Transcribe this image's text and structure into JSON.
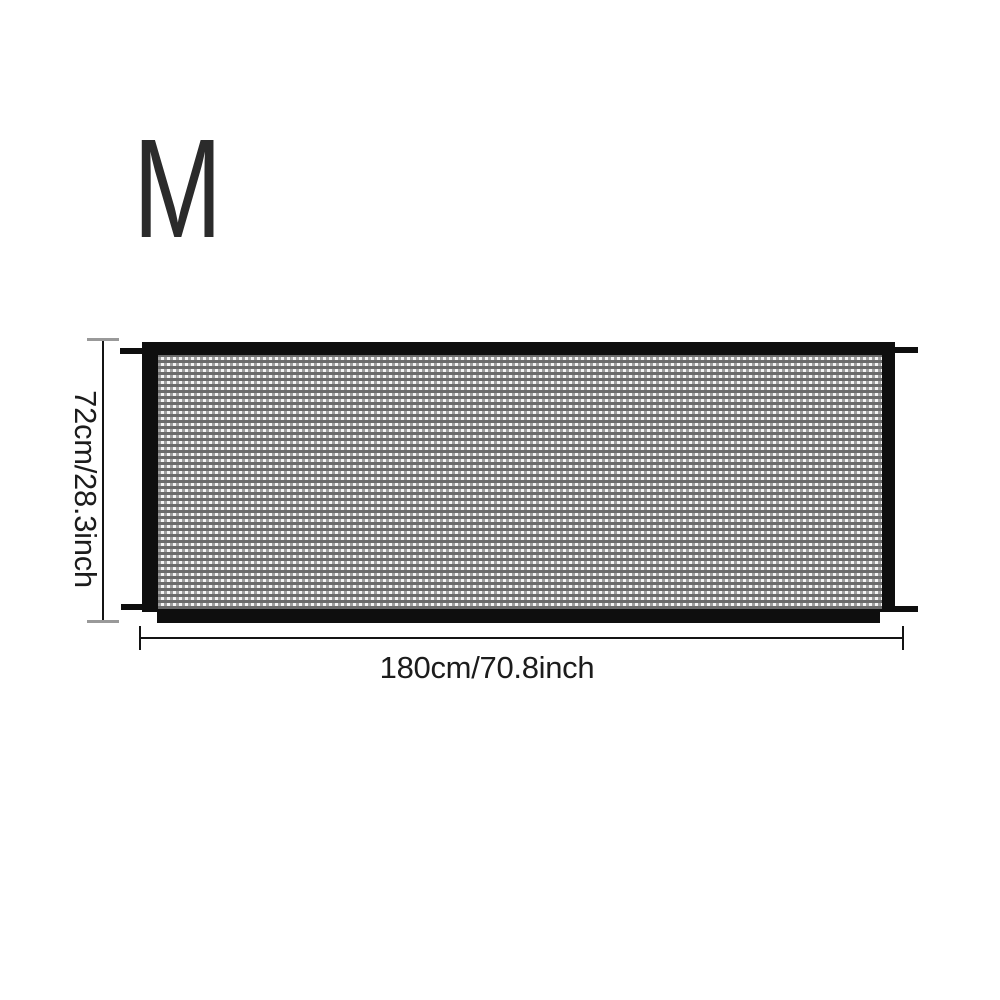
{
  "product_diagram": {
    "size_label": "M",
    "height_label": "72cm/28.3inch",
    "width_label": "180cm/70.8inch"
  },
  "colors": {
    "frame_black": "#0e0e0e",
    "label_text": "#1c1c1c",
    "size_text": "#2b2b2b",
    "dim_line": "#141414",
    "dim_cap_gray": "#999999",
    "mesh_hole": "#f5f5f5",
    "mesh_dark": "#6b6b6b",
    "mesh_mid": "#a0a0a0",
    "page_bg": "#ffffff"
  }
}
